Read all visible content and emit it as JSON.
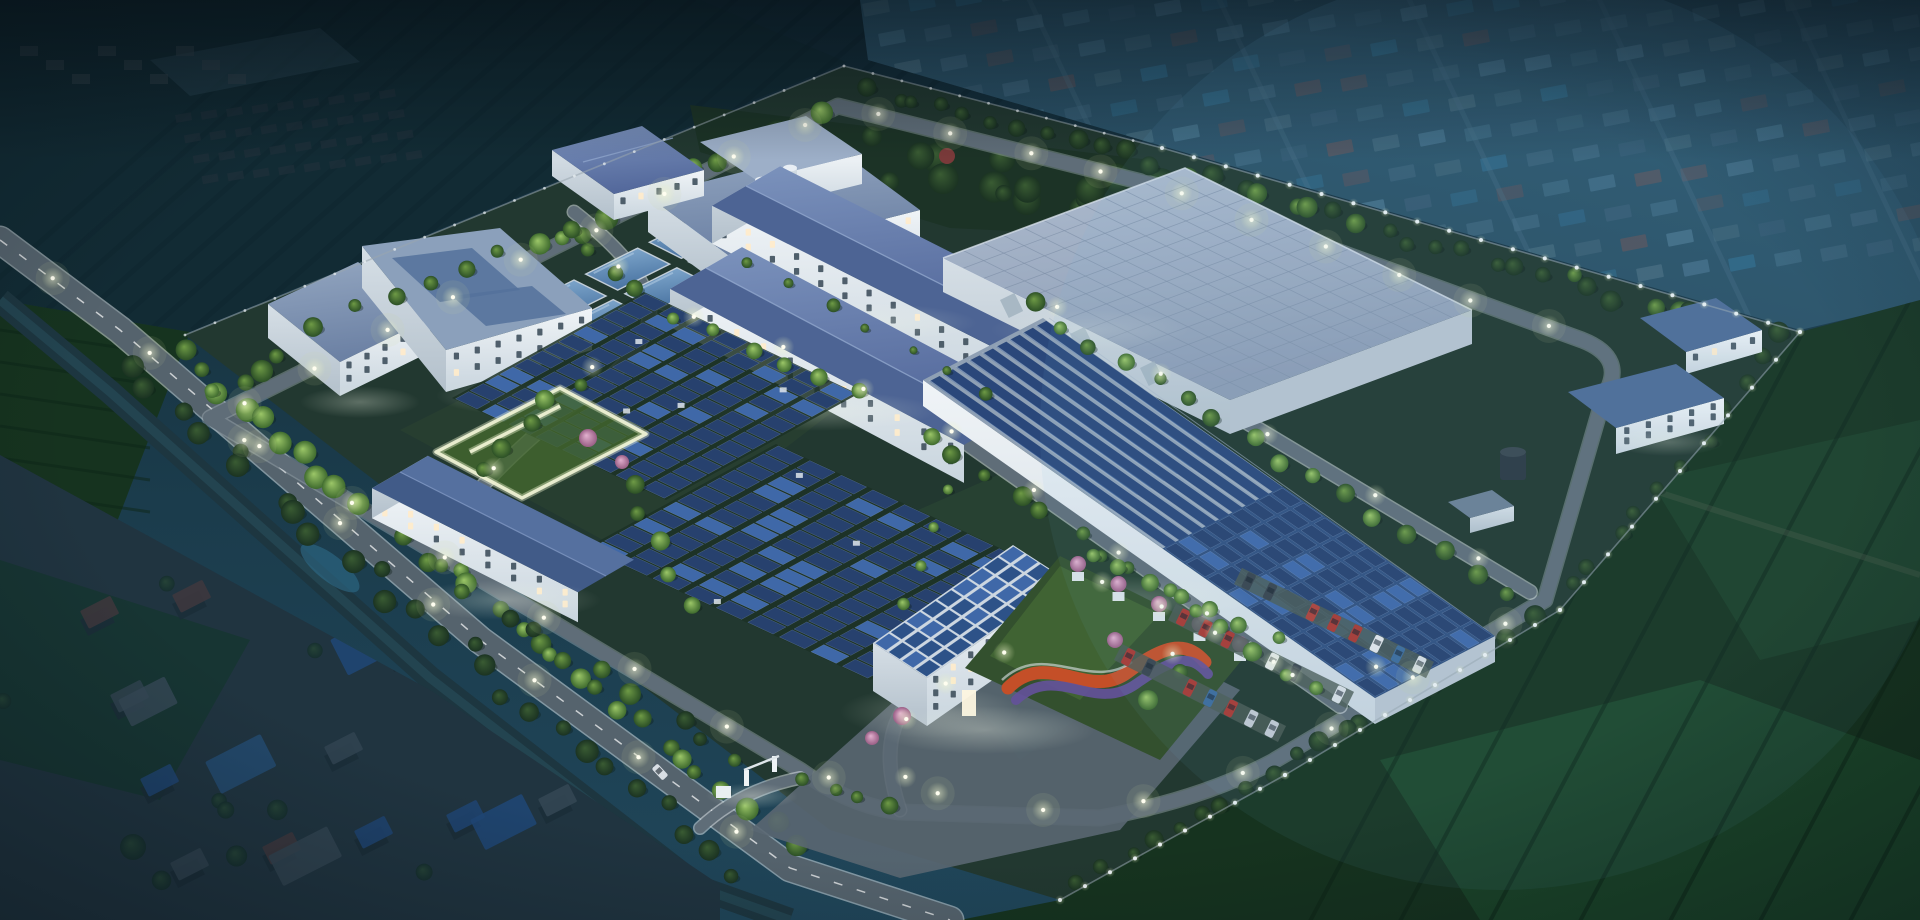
{
  "scene": {
    "type": "aerial-architectural-rendering",
    "time_of_day": "night",
    "description": "Bird's-eye night rendering of a fenced industrial water-treatment campus with rooftop and ground-mounted solar arrays, lit internal roads, tree belts and perimeter lights, surrounded by dark farmland, a canal, a main road and hazy villages",
    "canvas": {
      "width": 1920,
      "height": 920
    }
  },
  "palette": {
    "backdrop_top": "#132b37",
    "backdrop_bottom": "#20465a",
    "haze_village": "#3a7090",
    "orchard": "#122b34",
    "field_dark": "#16331f",
    "field_mid": "#1d4329",
    "field_light": "#265636",
    "hedge": "#0d2417",
    "canal": "#1d3640",
    "pond_blue": "#2f6f8e",
    "village_roof_red": "#6a4340",
    "village_roof_blue": "#2d5ea6",
    "village_roof_grey": "#55616c",
    "village_ground": "#2e3c44",
    "campus_ground": "#223830",
    "park_ground": "#1c3326",
    "lawn": "#33502e",
    "lawn_lit": "#55803c",
    "road_main": "#55636d",
    "road_internal": "#5f6d78",
    "road_edge": "#e8edf1",
    "road_shoulder": "#aab6bf",
    "plaza": "#5a6772",
    "wall_front": "#eef3f7",
    "wall_side": "#c9d5de",
    "window_dark": "#42525f",
    "window_lit": "#ffeccb",
    "roof_slab_light": "#93a6c0",
    "roof_slab_dark": "#6c81a4",
    "gable_light": "#7b92bc",
    "gable_dark": "#54699c",
    "warehouse_roof_light": "#aebccf",
    "warehouse_roof_dark": "#8c9cb4",
    "warehouse_gridline": "#7f90a8",
    "pool_water_light": "#86aed2",
    "pool_water_deep": "#4a74a2",
    "lane_water": "#2a477a",
    "lane_divider": "#aab8ca",
    "solar_panel": "#27416e",
    "solar_panel_lit": "#3f68a8",
    "solar_frame": "#9fb2c8",
    "tree_lit": "#9cc768",
    "tree_mid": "#6f9b46",
    "tree_dark": "#3a5c33",
    "tree_blossom": "#cc8fb4",
    "flower_red": "#c44f28",
    "flower_purple": "#64519b",
    "lamp_core": "#fffef0",
    "lamp_glow": "#f4f8d2",
    "fence_post": "#eef3f6",
    "flag_red": "#bf2e27",
    "tank_dark": "#2c3842",
    "car_colors": [
      "#d8dee4",
      "#a93832",
      "#8d9aa6",
      "#3d6b9b",
      "#39434d",
      "#c2c9d1",
      "#b0413a",
      "#e2e6ea"
    ]
  },
  "elements": {
    "ground_solar_array_1": {
      "rows": 8,
      "cols": 13
    },
    "ground_solar_array_2": {
      "rows": 9,
      "cols": 13
    },
    "basin_roof_solar": {
      "rows": 9,
      "cols": 10
    },
    "office_roof_solar": {
      "rows": 4,
      "cols": 9
    },
    "treatment_basin_lanes": {
      "count": 9
    },
    "clarifier_pools": {
      "count": 6
    },
    "equipment_silos": {
      "count": 2
    },
    "flag_poles": {
      "count": 3
    },
    "parking_rows": {
      "count": 3
    },
    "parking_cars": {
      "count": 25
    },
    "street_lamps": {
      "approx_count": 66
    },
    "perimeter_light_posts": {
      "approx_count": 84
    },
    "road_cars": {
      "count": 2
    }
  },
  "regions": [
    {
      "id": "orchard-northwest",
      "label": "dark orchard and farm plots outside north-west fence"
    },
    {
      "id": "village-top-right",
      "label": "hazy village grid beyond north-east fence"
    },
    {
      "id": "village-bottom-left",
      "label": "village with red and blue metal roofs"
    },
    {
      "id": "fields-southeast",
      "label": "dark crop fields east and south of campus"
    },
    {
      "id": "canal",
      "label": "tree-lined canal along the main road"
    },
    {
      "id": "main-road",
      "label": "public road with street lamps along south-west edge"
    },
    {
      "id": "campus",
      "label": "fenced treatment-plant campus"
    },
    {
      "id": "park-northeast",
      "label": "dense dark tree park inside north fence"
    },
    {
      "id": "clarifier-pools",
      "label": "open water clarifier pools"
    },
    {
      "id": "left-process-buildings",
      "label": "flat-roof process buildings, west cluster"
    },
    {
      "id": "north-process-hall",
      "label": "process hall with two silos"
    },
    {
      "id": "long-workshops",
      "label": "two long blue-gable workshop buildings"
    },
    {
      "id": "warehouse",
      "label": "large flat grid-roof warehouse"
    },
    {
      "id": "covered-basin",
      "label": "long open treatment basin, half covered by solar roof"
    },
    {
      "id": "ground-solar-arrays",
      "label": "two tilted ground solar panel fields"
    },
    {
      "id": "dosing-building",
      "label": "small blue-gable building with lit courtyard path"
    },
    {
      "id": "admin-office",
      "label": "three-storey office building with rooftop solar"
    },
    {
      "id": "flag-poles",
      "label": "three red flags in front of office"
    },
    {
      "id": "ornamental-garden",
      "label": "lawn garden with red and purple flower ribbons"
    },
    {
      "id": "parking",
      "label": "angled visitor parking rows with cars"
    },
    {
      "id": "entrance-gate",
      "label": "south entrance gate and guard booth"
    },
    {
      "id": "east-utility-buildings",
      "label": "small utility buildings and dark storage tank, east corner"
    }
  ]
}
